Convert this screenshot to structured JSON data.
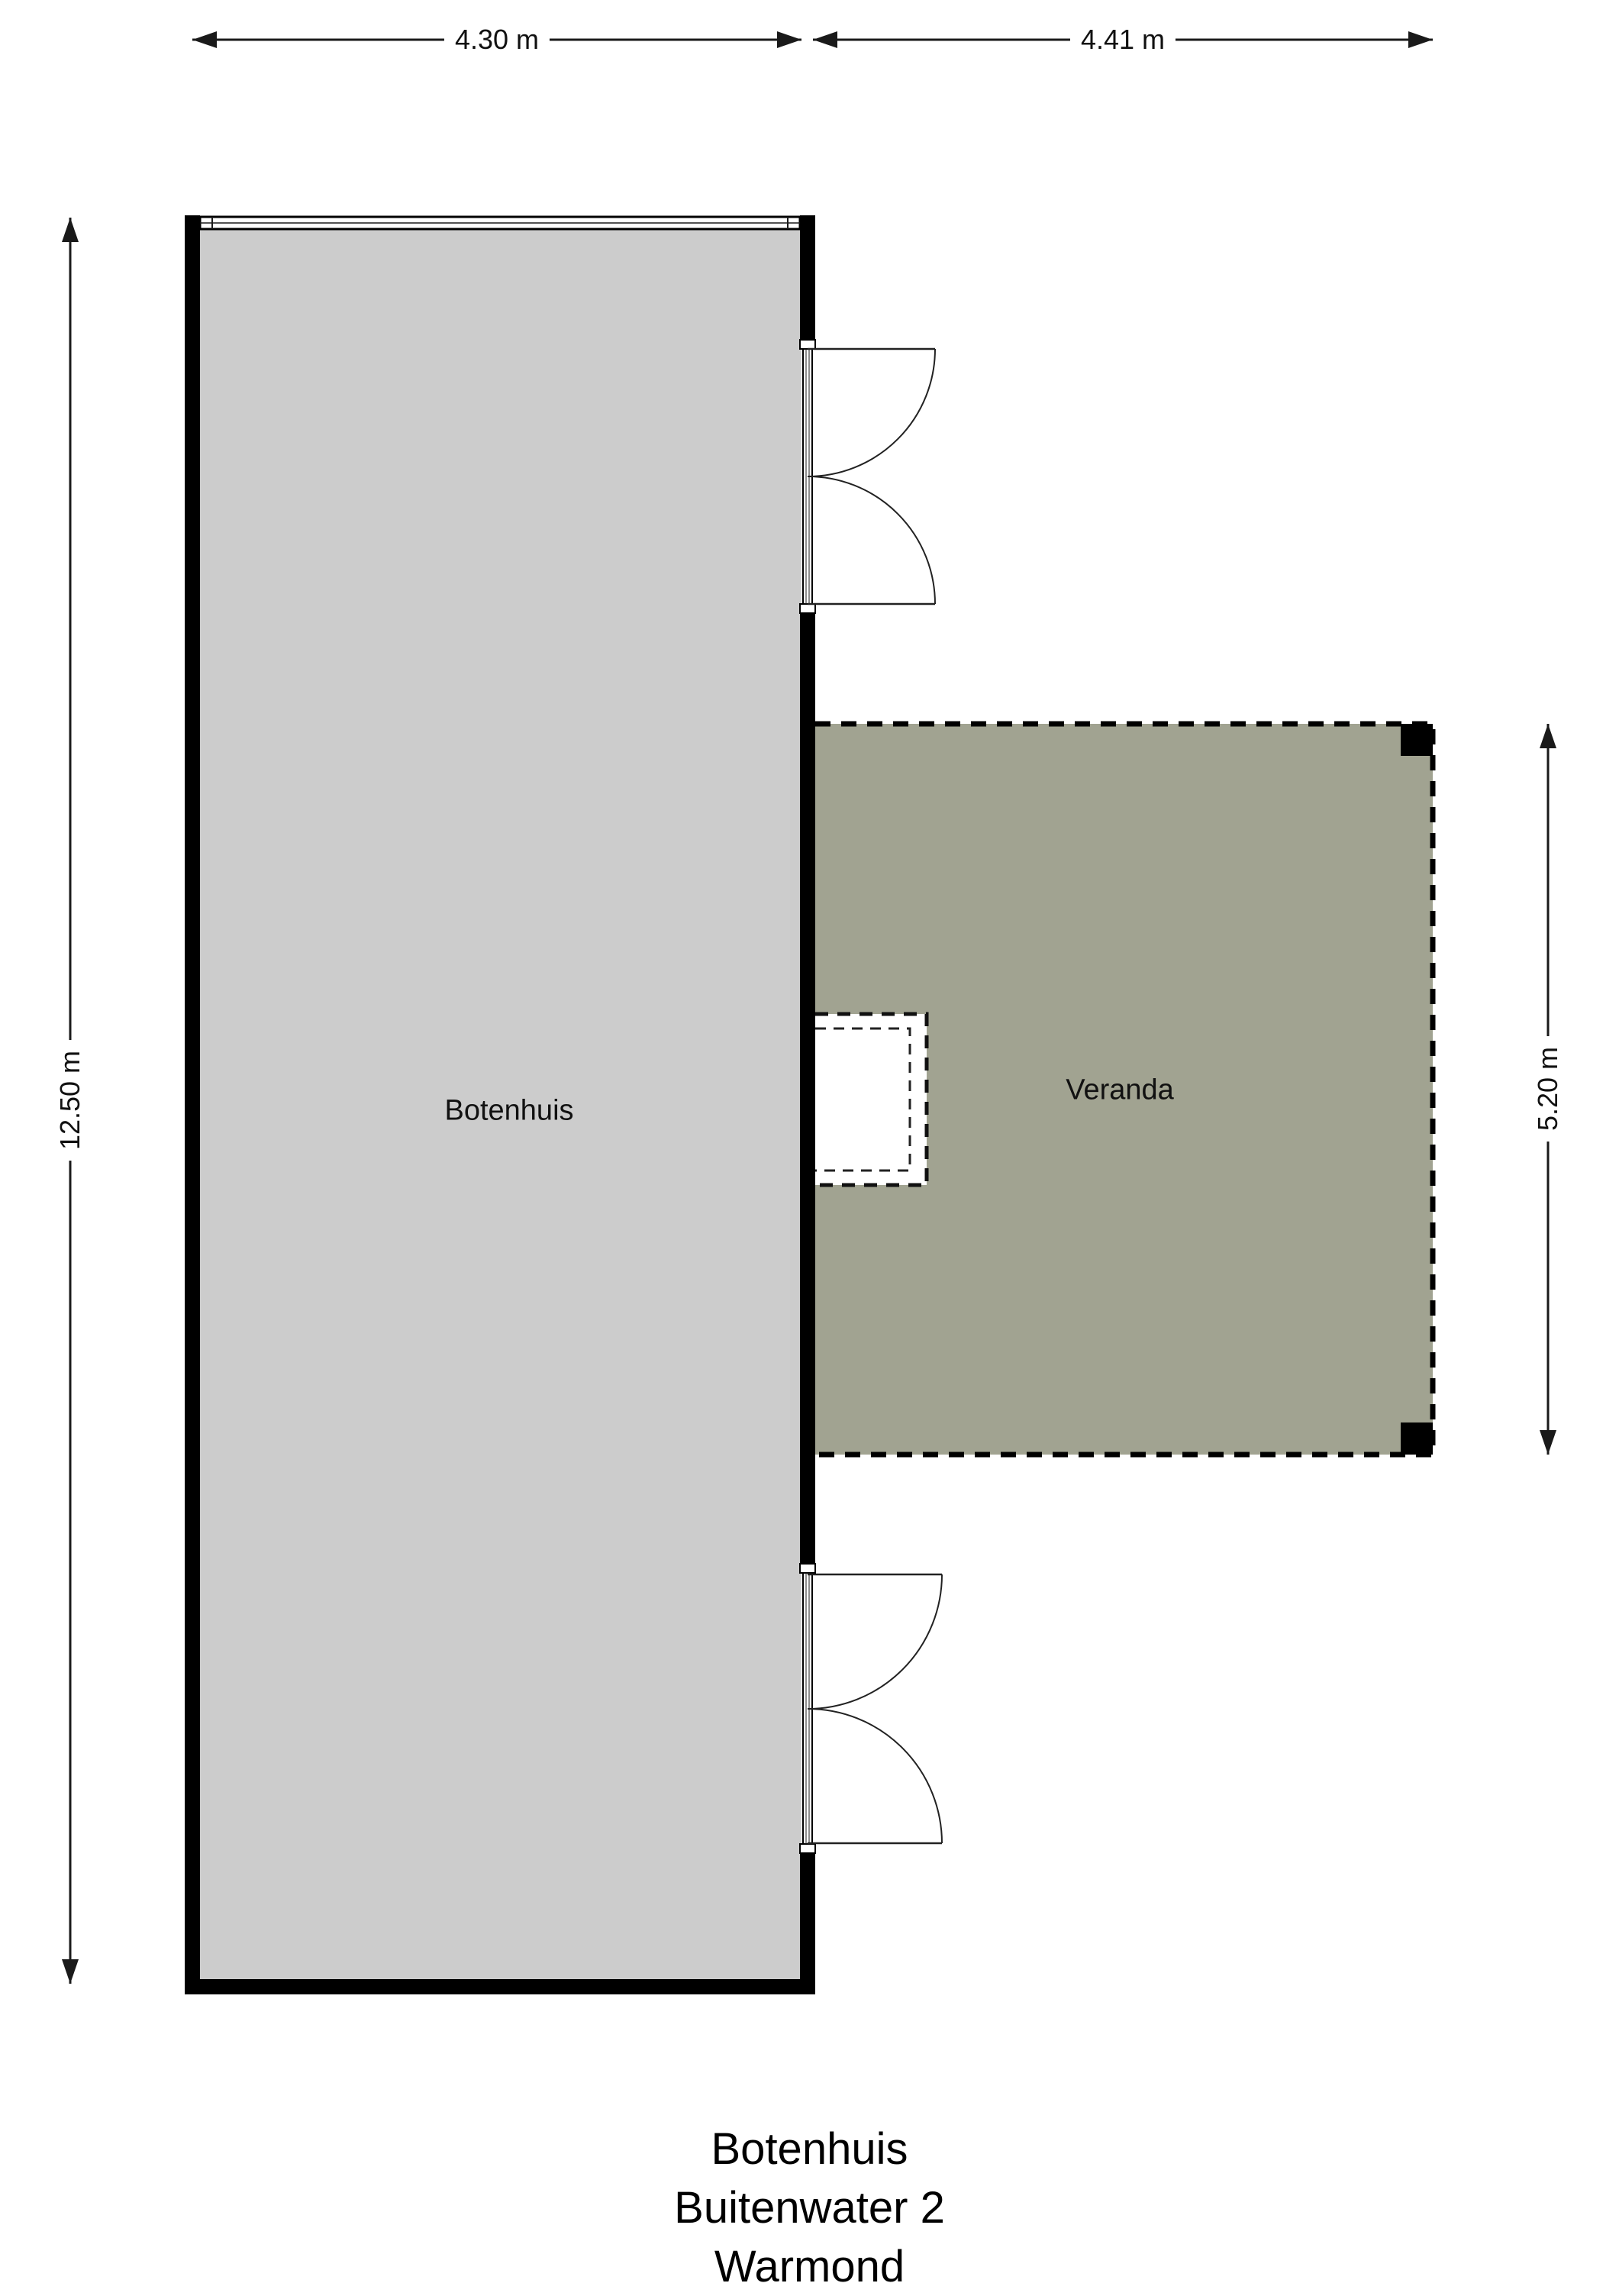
{
  "dimensions": {
    "botenhuis_width": "4.30 m",
    "veranda_width": "4.41 m",
    "botenhuis_height": "12.50 m",
    "veranda_height": "5.20 m"
  },
  "rooms": {
    "botenhuis": "Botenhuis",
    "veranda": "Veranda"
  },
  "footer": {
    "line1": "Botenhuis",
    "line2": "Buitenwater 2",
    "line3": "Warmond"
  },
  "colors": {
    "wall": "#000000",
    "room_fill": "#cccccc",
    "veranda_fill": "#a1a391",
    "line": "#1a1a1a",
    "page_bg": "#ffffff"
  }
}
